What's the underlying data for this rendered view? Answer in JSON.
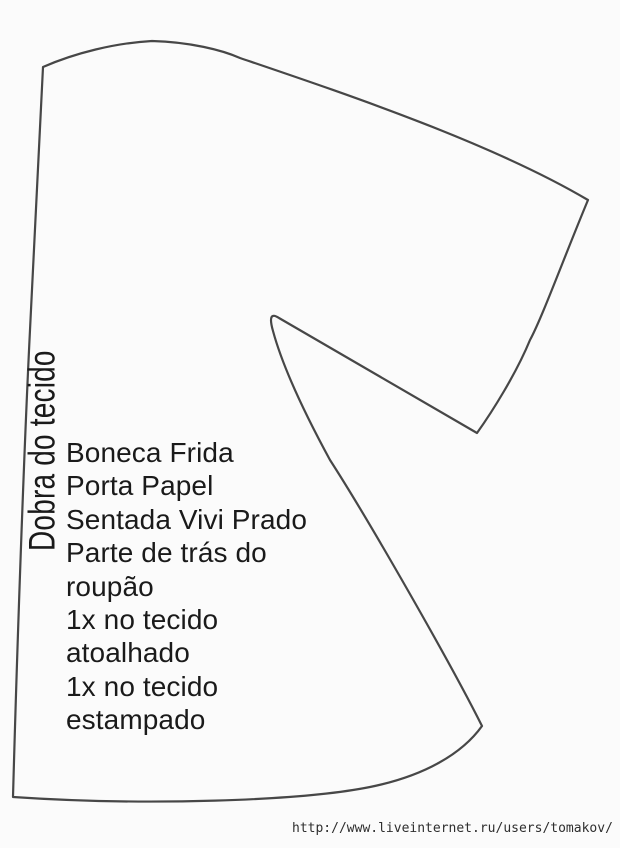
{
  "canvas": {
    "width": 620,
    "height": 848,
    "background": "#fbfbfb",
    "outline_color": "#474747",
    "text_color": "#1a1a1a",
    "watermark_color": "#2e2e2e"
  },
  "pattern": {
    "fold_label": "Dobra do tecido",
    "annotation": {
      "lines": [
        "Boneca Frida",
        "Porta Papel",
        "Sentada Vivi Prado",
        "Parte de trás do",
        "roupão",
        "1x no tecido",
        "atoalhado",
        "1x no tecido",
        "estampado"
      ]
    }
  },
  "watermark": {
    "url": "http://www.liveinternet.ru/users/tomakov/"
  }
}
